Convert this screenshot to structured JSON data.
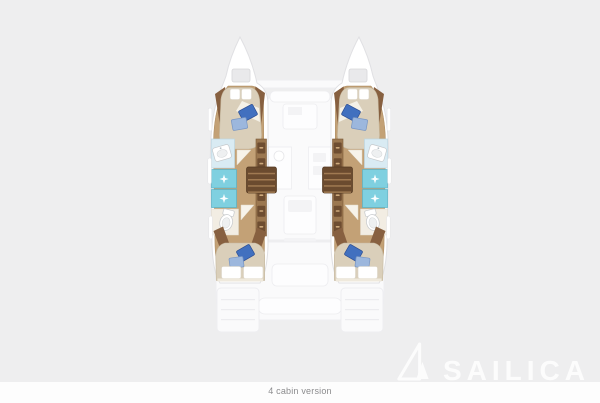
{
  "caption": "4 cabin version",
  "watermark": {
    "text": "SAILICA",
    "icon": "sail-logo-icon"
  },
  "floorplan": {
    "type": "catamaran-deck-plan",
    "version_label": "4 cabin version",
    "cabin_count": 4,
    "hulls": [
      {
        "side": "port",
        "rooms": [
          "forward-cabin",
          "bathroom-with-shower",
          "aft-cabin"
        ]
      },
      {
        "side": "starboard",
        "rooms": [
          "forward-cabin",
          "bathroom-with-shower",
          "aft-cabin"
        ]
      }
    ],
    "ghosted_areas": [
      "bows",
      "saloon-seating",
      "saloon-table",
      "galley",
      "cockpit",
      "transom-steps"
    ]
  },
  "colors": {
    "background": "#eeeeef",
    "footer": "#fdfdfd",
    "caption_text": "#8c8c8e",
    "watermark": "#ffffff",
    "hull_fill": "#ffffff",
    "hull_stroke": "#e0e0e3",
    "wood": "#c3a176",
    "wood_edge": "#aa8a60",
    "trim": "#876040",
    "cabinet": "#9b7750",
    "cabinet_edge": "#7b5937",
    "drawer": "#6e4d31",
    "drawer_handle": "#cda97c",
    "steps": "#6b4b2f",
    "steps_edge": "#543a23",
    "step_line": "#a07a52",
    "mattress": "#dacfba",
    "mattress_edge": "#c5b89f",
    "sheet": "#f7f4ec",
    "pillow": "#ffffff",
    "pillow_edge": "#dbd5c7",
    "blue_pillow": "#4170bf",
    "blue_pillow_edge": "#2e4f93",
    "blue_pillow_light": "#9cb7dd",
    "blue_pillow_light_edge": "#7895c2",
    "teal": "#7fd0e0",
    "teal_edge": "#58b2c6",
    "counter": "#d9ebf3",
    "counter_edge": "#bdd7e3",
    "porcelain": "#ffffff",
    "porcelain_edge": "#c6c9cc",
    "tile": "#f2ede3",
    "tile_edge": "#e3dccd",
    "door": "#f7f3ea",
    "door_edge": "#e2dbcb",
    "window": "#ffffff",
    "window_edge": "#e3e3e6",
    "ghost_fill": "#fafafb",
    "ghost_fill_light": "#fdfdfe",
    "ghost_stroke": "#ededf0",
    "ghost_inner": "#f3f3f5",
    "hatch": "#e9e9eb",
    "hatch_edge": "#d6d6d9"
  }
}
